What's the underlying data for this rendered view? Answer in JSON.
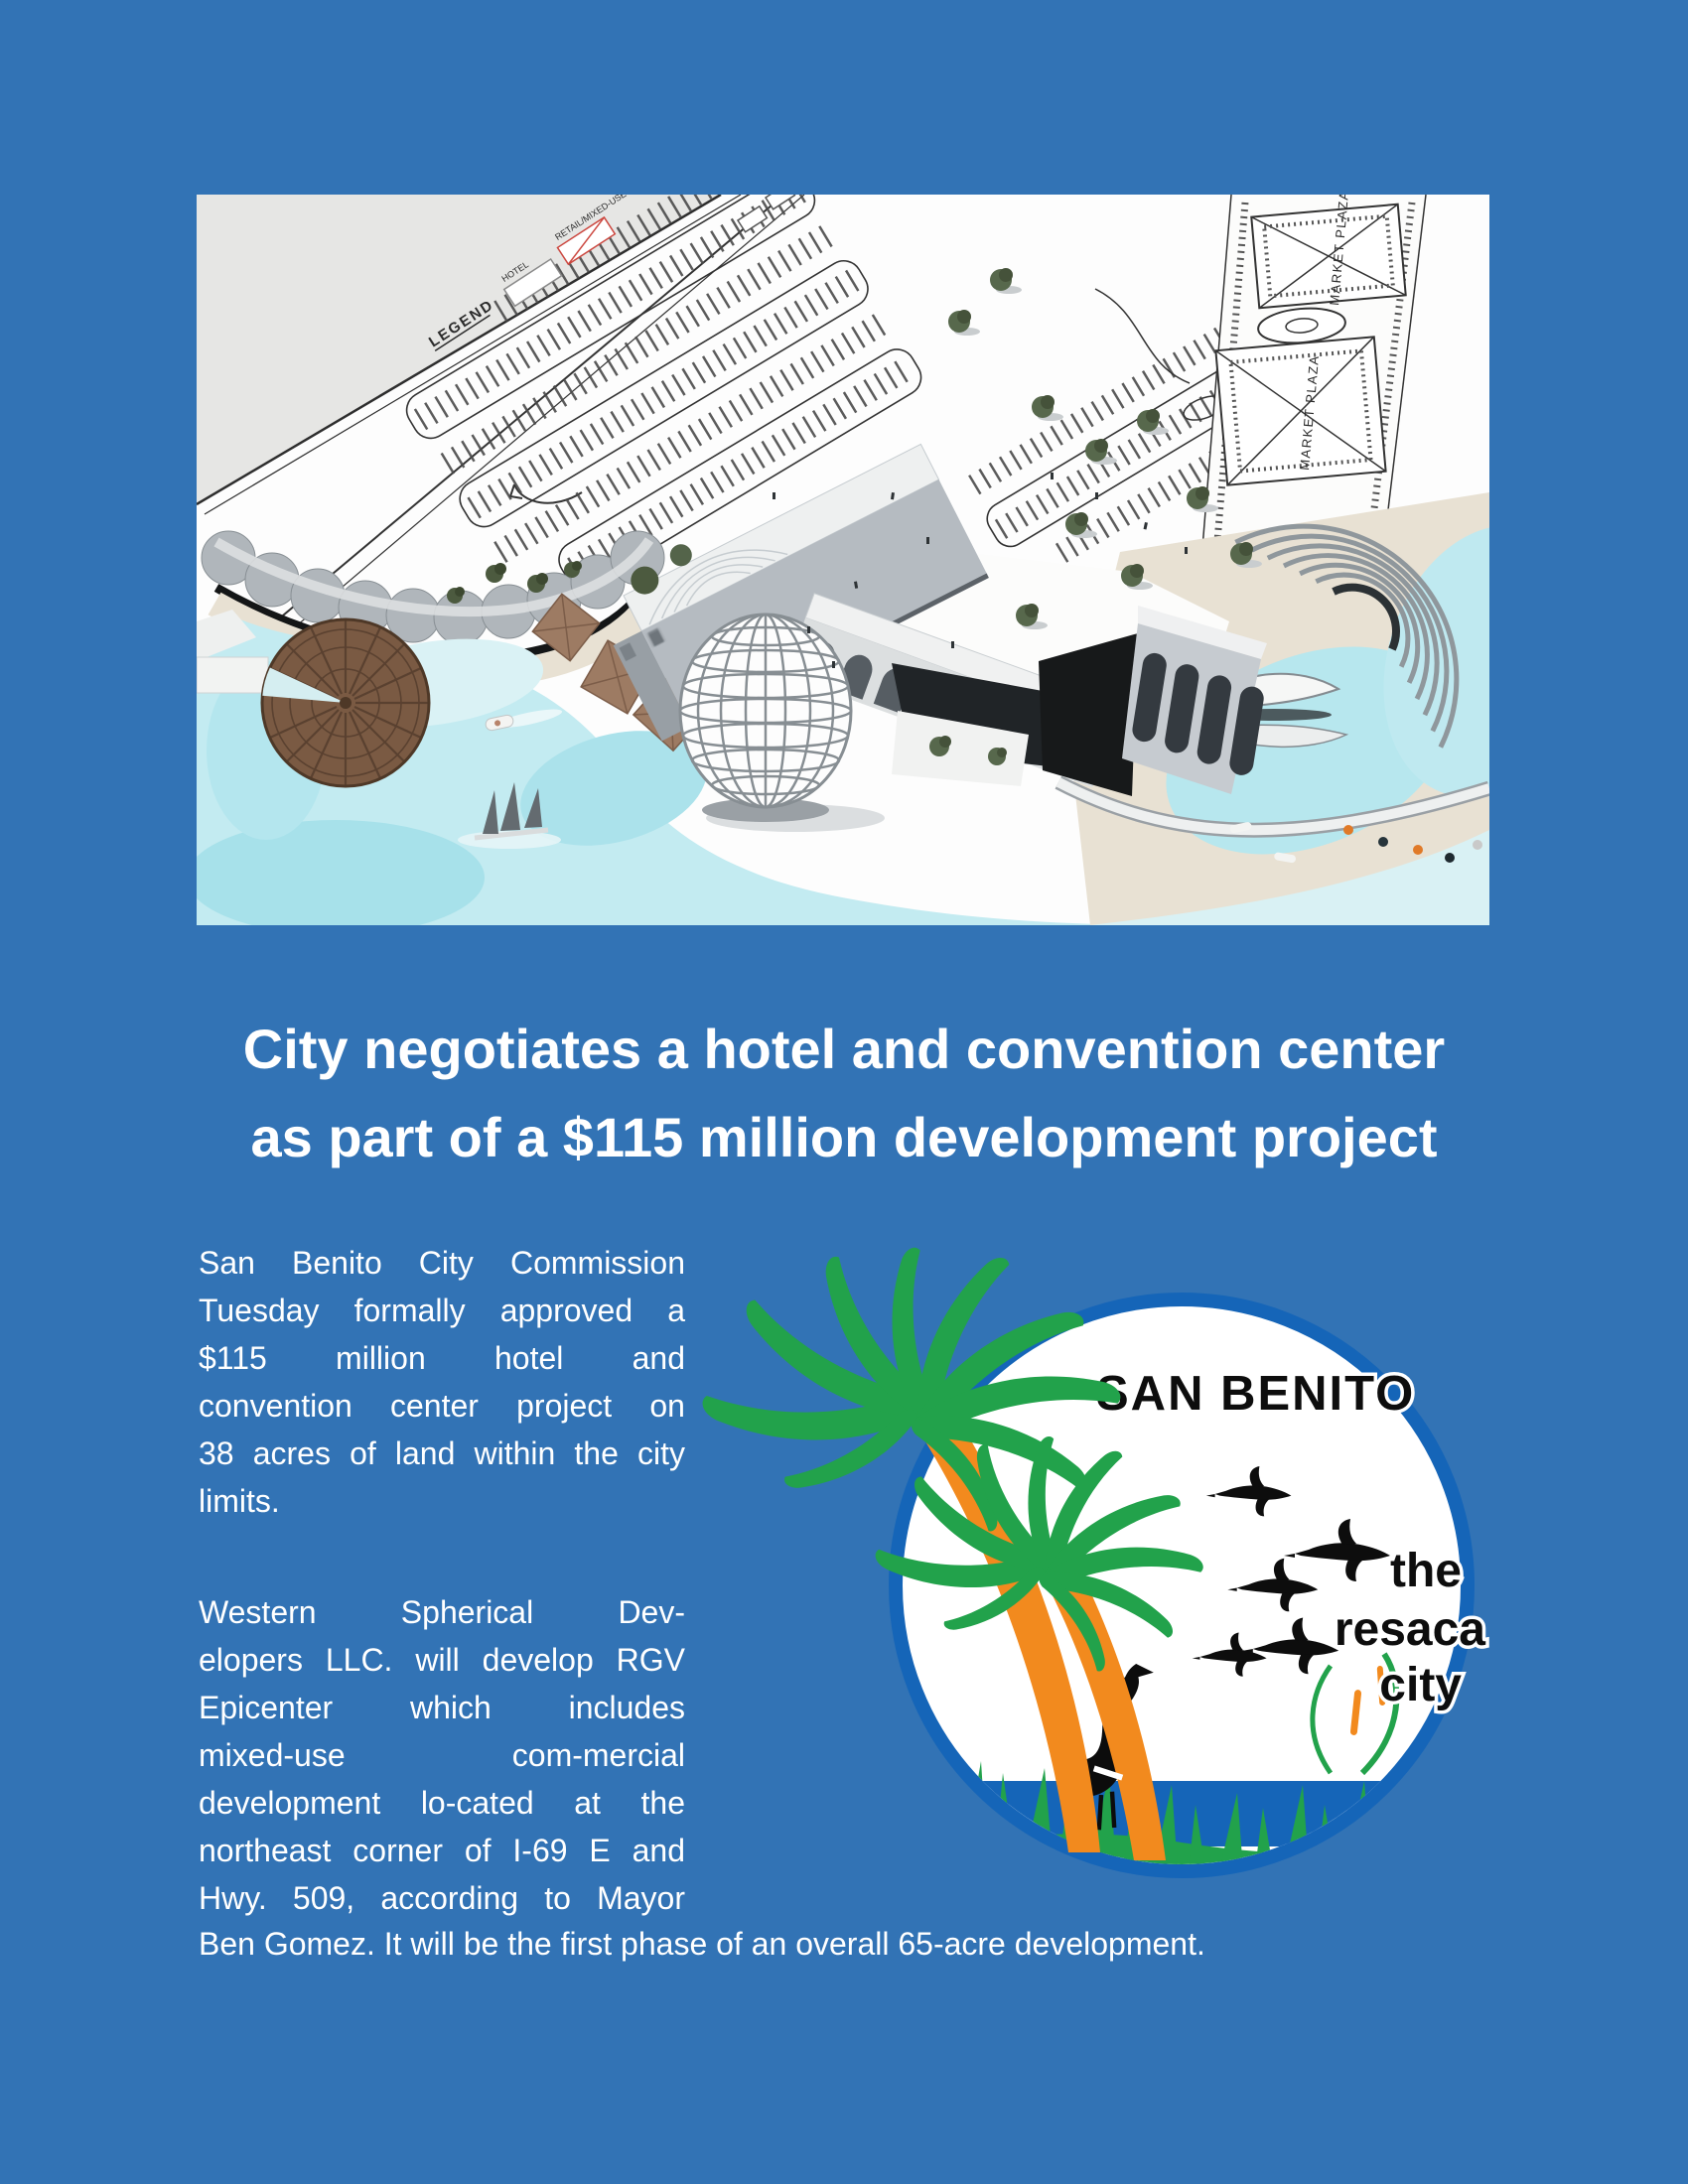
{
  "page": {
    "background": "#3273b5",
    "text_color": "#ffffff"
  },
  "headline": {
    "line1": "City negotiates a hotel and convention center",
    "line2": "as part of a $115 million development project"
  },
  "article": {
    "para1_lines": [
      "San Benito City Commission",
      "Tuesday formally approved a",
      "$115 million hotel and",
      "convention center project on",
      "38 acres of land within the city",
      "limits."
    ],
    "para2_lines": [
      "Western Spherical Dev-",
      "elopers LLC. will develop RGV",
      "Epicenter which includes",
      "mixed-use com-mercial",
      "development lo-cated at the",
      "northeast corner of I-69 E and",
      "Hwy. 509, according to Mayor"
    ],
    "closing_line": "Ben Gomez. It will be the first phase of an overall 65-acre development."
  },
  "rendering": {
    "legend_title": "LEGEND",
    "legend_hotel_label": "HOTEL",
    "legend_retail_label": "RETAIL/MIXED-USE",
    "plaza_label": "MARKET PLAZA",
    "colors": {
      "water": "#c3ebf1",
      "sand": "#e8e1d3",
      "plan_line": "#3c3c3c",
      "retail_swatch": "#cc4840"
    }
  },
  "logo": {
    "city_name": "SAN BENITO",
    "tagline_line1": "the",
    "tagline_line2": "resaca",
    "tagline_line3": "city",
    "colors": {
      "ring": "#1565b8",
      "palm_green": "#22a24b",
      "trunk_orange": "#f28a1e",
      "silhouette": "#0d0d0d",
      "water": "#1565b8",
      "grass": "#22a24b"
    }
  }
}
